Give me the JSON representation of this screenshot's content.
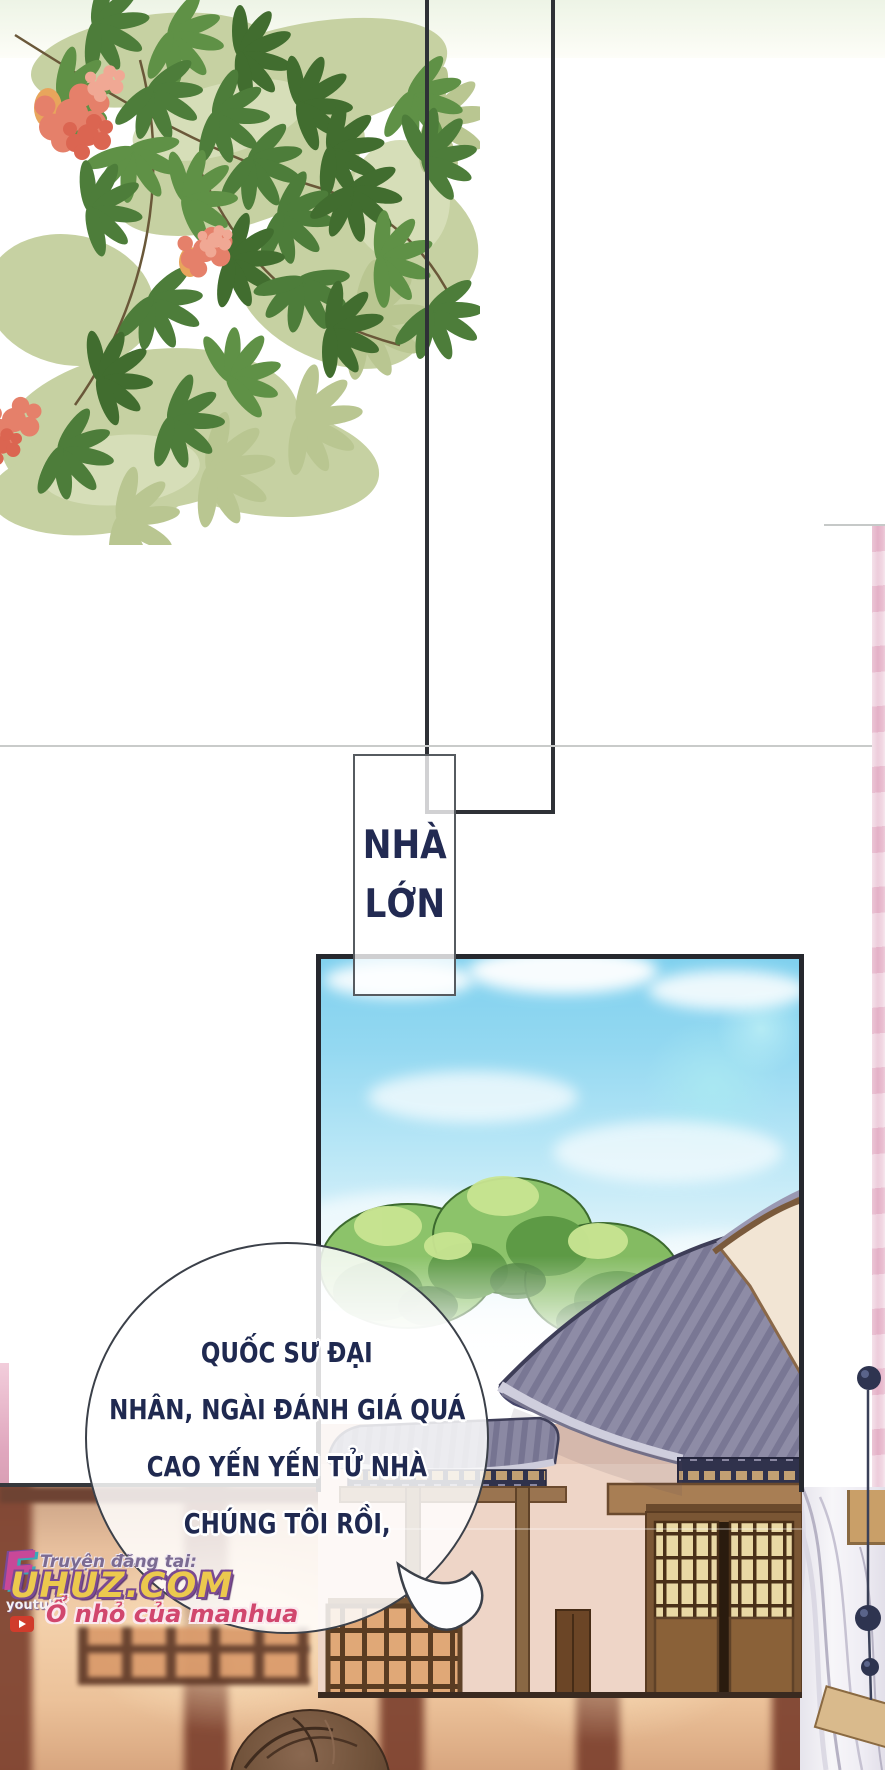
{
  "page_title": "manhua page",
  "caption_box": {
    "lines": [
      "NHÀ",
      "LỚN"
    ],
    "text_color": "#222a52"
  },
  "speech_bubble": {
    "lines": [
      "QUỐC SƯ ĐẠI",
      "NHÂN, NGÀI ĐÁNH GIÁ QUÁ",
      "CAO YẾN YẾN TỬ NHÀ",
      "CHÚNG TÔI RỒI,"
    ],
    "text_color": "#1f2950"
  },
  "watermark": {
    "logo_letter": "F",
    "prefix": "Truyện đăng tại:",
    "site": "UHUZ.COM",
    "youtube_label": "youtube",
    "tagline": "Ổ nhỏ của manhua",
    "site_color": "#ecc94e",
    "site_outline": "#7a4a92",
    "tagline_color": "#d1476e",
    "prefix_color": "#7b6b92"
  },
  "colors": {
    "panel_border": "#26282e",
    "sky_blue": "#7fd0ee",
    "tree_green": "#8cc36a",
    "roof_slate": "#8e8ca6",
    "wall_cream": "#eed5c7",
    "curtain_pink": "#e2afc6",
    "interior_warm": "#f3d0aa",
    "bead_navy": "#2e3450"
  }
}
